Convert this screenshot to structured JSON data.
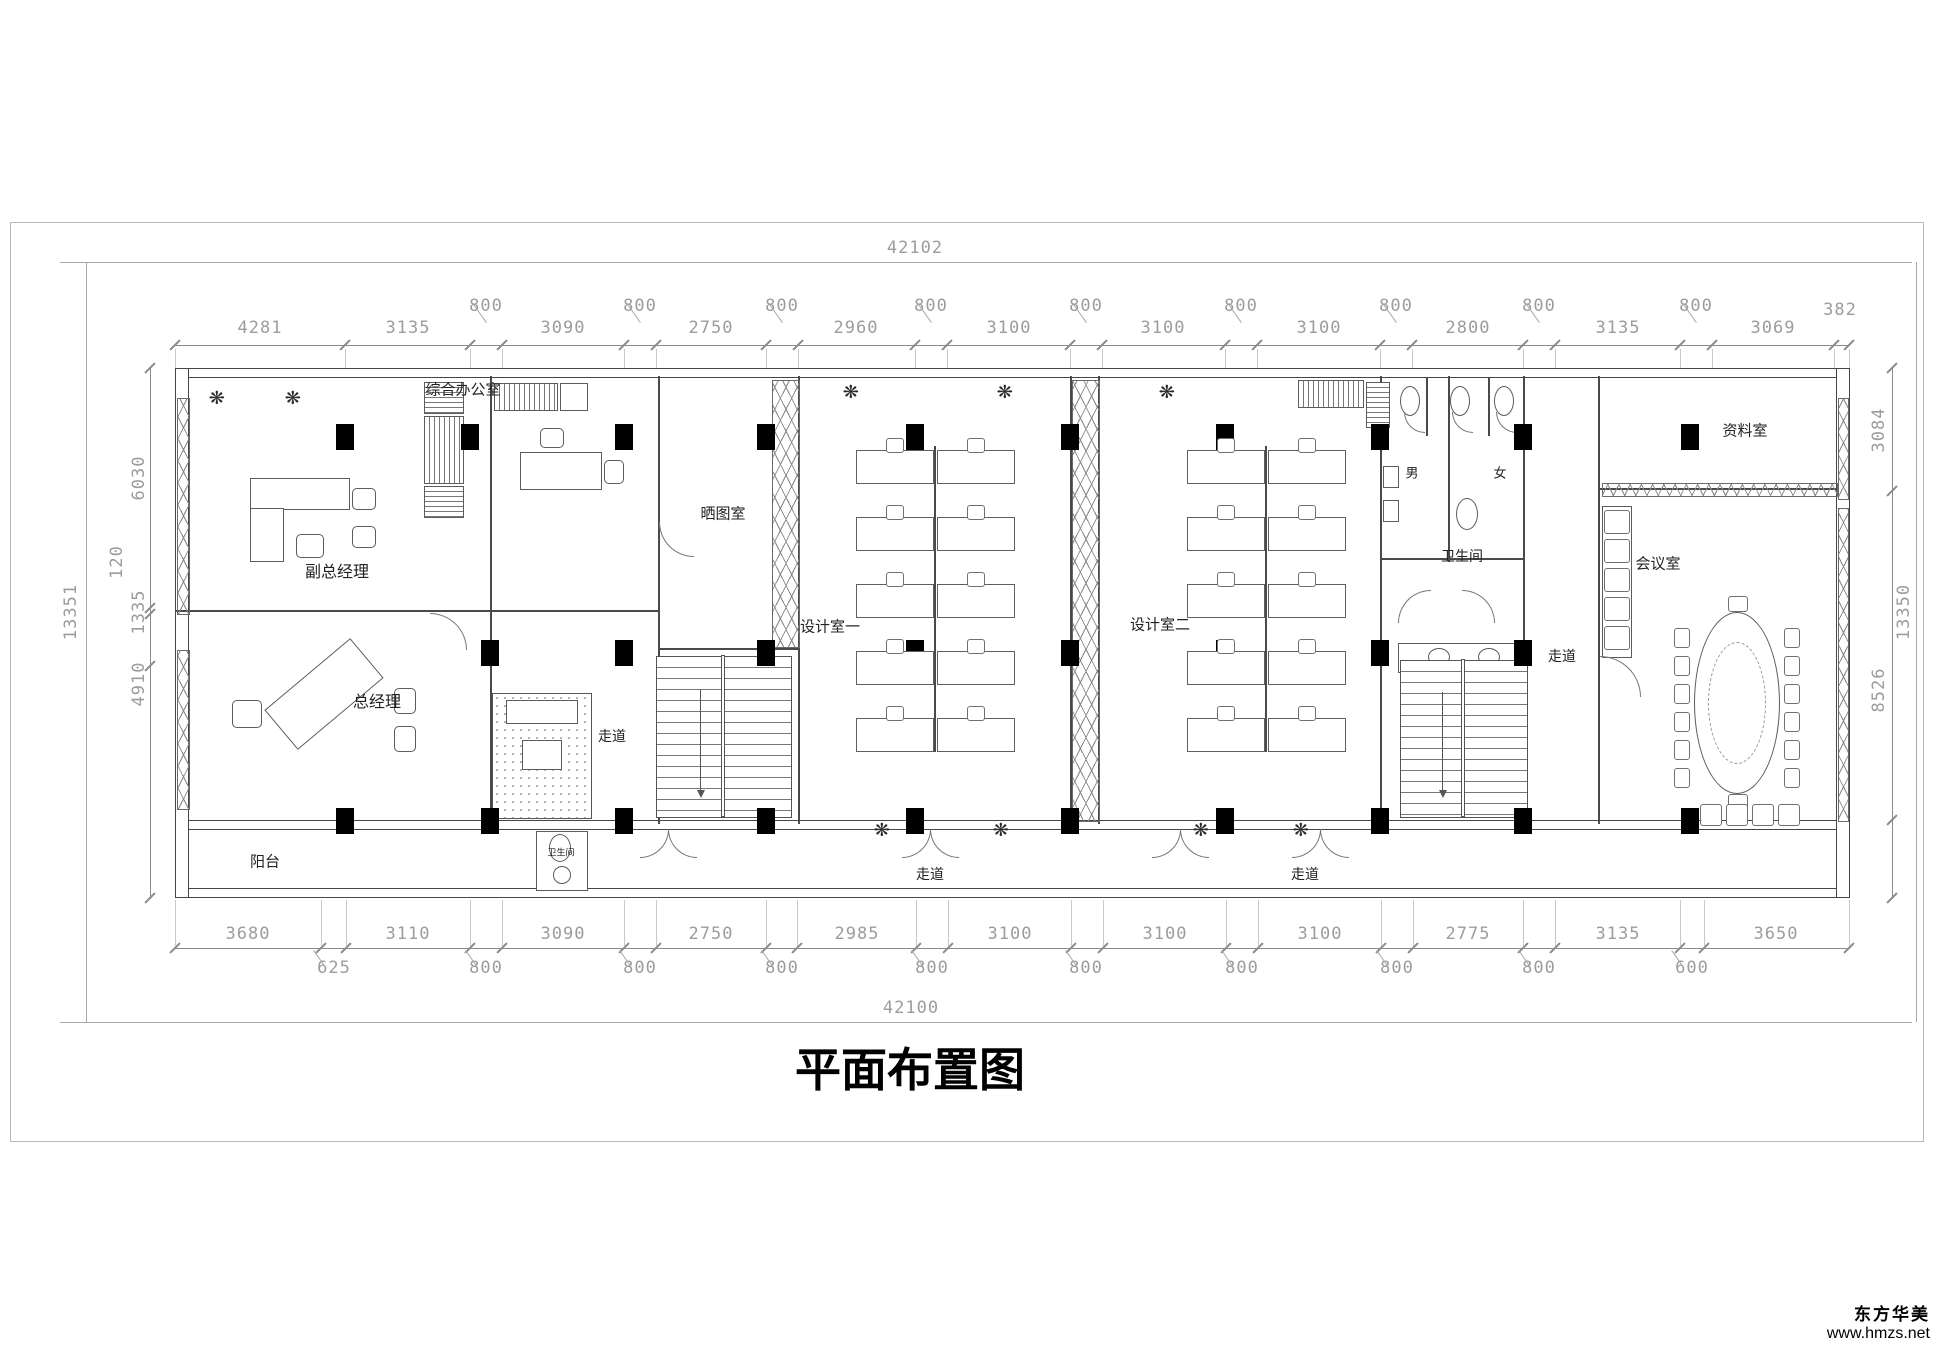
{
  "drawing_title": "平面布置图",
  "watermark": {
    "brand": "东方华美",
    "site": "www.hmzs.net"
  },
  "icons": {
    "plant_glyph": "❋"
  },
  "rooms": {
    "deputy_gm": "副总经理",
    "gm": "总经理",
    "general_office": "综合办公室",
    "blueprint_room": "晒图室",
    "design_room_1": "设计室一",
    "design_room_2": "设计室二",
    "archive_room": "资料室",
    "meeting_room": "会议室",
    "toilet": "卫生间",
    "toilet_small": "卫生间",
    "male": "男",
    "female": "女",
    "balcony": "阳台",
    "corridor": "走道"
  },
  "dims": {
    "top_total": "42102",
    "bottom_total": "42100",
    "left_total": "13351",
    "right_total": "13350",
    "right_top": "382",
    "top_main": [
      "4281",
      "3135",
      "3090",
      "2750",
      "2960",
      "3100",
      "3100",
      "3100",
      "2800",
      "3135",
      "3069"
    ],
    "top_sub": [
      "800",
      "800",
      "800",
      "800",
      "800",
      "800",
      "800",
      "800",
      "800"
    ],
    "bottom_main": [
      "3680",
      "3110",
      "3090",
      "2750",
      "2985",
      "3100",
      "3100",
      "3100",
      "2775",
      "3135",
      "3650"
    ],
    "bottom_sub": [
      "625",
      "800",
      "800",
      "800",
      "800",
      "800",
      "800",
      "800",
      "800",
      "600"
    ],
    "left_chain": [
      "6030",
      "120",
      "1335",
      "4910"
    ],
    "right_chain": [
      "3084",
      "8526"
    ]
  }
}
